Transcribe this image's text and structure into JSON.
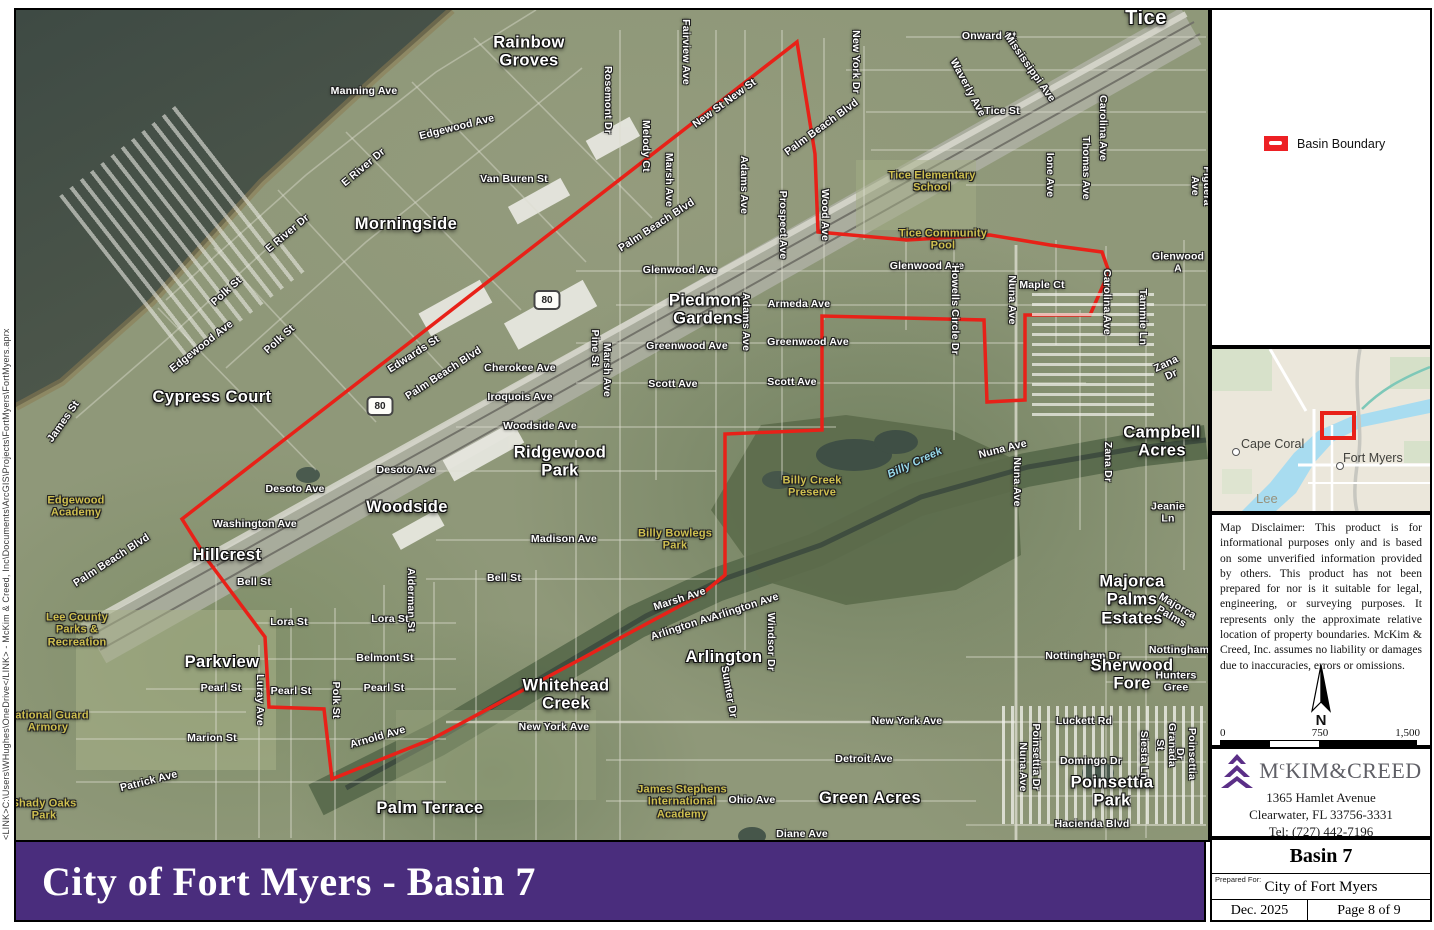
{
  "file_path_text": "<LINK>C:\\Users\\WHughes\\OneDrive</LINK> - McKim & Creed, Inc\\Documents\\ArcGIS\\Projects\\FortMyers\\FortMyers.aprx",
  "banner": {
    "title": "City of Fort Myers - Basin 7"
  },
  "theme": {
    "purple": "#4a2d7d",
    "logo_purple": "#5b2f87",
    "boundary_red": "#e82118"
  },
  "legend": {
    "items": [
      {
        "label": "Basin Boundary",
        "color": "#ed2024"
      }
    ]
  },
  "inset": {
    "cape_coral": "Cape Coral",
    "fort_myers": "Fort Myers",
    "county": "Lee"
  },
  "disclaimer": "Map Disclaimer: This product is for informational purposes only and is based on some unverified information provided by others. This product has not been prepared for nor is it suitable for legal, engineering, or surveying purposes. It represents only the approximate relative location of property boundaries. McKim & Creed, Inc. assumes no liability or damages due to inaccuracies, errors or omissions.",
  "north_label": "N",
  "scale_bar": {
    "start": "0",
    "mid": "750",
    "end": "1,500",
    "units": "Feet"
  },
  "company": {
    "name_prefix": "M",
    "name_sup": "c",
    "name_rest": "KIM&CREED",
    "address1": "1365 Hamlet Avenue",
    "address2": "Clearwater, FL 33756-3331",
    "phone": "Tel: (727) 442-7196"
  },
  "title_block": {
    "title": "Basin 7",
    "prepared_for_label": "Prepared For:",
    "prepared_for": "City of Fort Myers",
    "date": "Dec. 2025",
    "page": "Page 8 of 9"
  },
  "map": {
    "highway_shield": "80",
    "boundary_color": "#e82118",
    "shields": [
      {
        "x": 531,
        "y": 290
      },
      {
        "x": 364,
        "y": 396
      }
    ],
    "boundary_points": [
      [
        781,
        32
      ],
      [
        799,
        144
      ],
      [
        802,
        222
      ],
      [
        891,
        230
      ],
      [
        974,
        225
      ],
      [
        1034,
        235
      ],
      [
        1086,
        242
      ],
      [
        1093,
        262
      ],
      [
        1074,
        305
      ],
      [
        1009,
        305
      ],
      [
        1009,
        390
      ],
      [
        971,
        392
      ],
      [
        968,
        310
      ],
      [
        806,
        306
      ],
      [
        806,
        420
      ],
      [
        709,
        424
      ],
      [
        709,
        565
      ],
      [
        686,
        584
      ],
      [
        416,
        729
      ],
      [
        316,
        769
      ],
      [
        308,
        699
      ],
      [
        253,
        697
      ],
      [
        249,
        627
      ],
      [
        193,
        552
      ],
      [
        166,
        509
      ]
    ],
    "labels": [
      {
        "t": "Onward St",
        "x": 973,
        "y": 27
      },
      {
        "t": "Rainbow\nGroves",
        "x": 513,
        "y": 42,
        "c": "pl"
      },
      {
        "t": "Manning Ave",
        "x": 348,
        "y": 82
      },
      {
        "t": "Edgewood Ave",
        "x": 441,
        "y": 118,
        "r": -14
      },
      {
        "t": "New St New St",
        "x": 709,
        "y": 94,
        "r": -36
      },
      {
        "t": "Palm Beach Blvd",
        "x": 806,
        "y": 118,
        "r": -36
      },
      {
        "t": "Van Buren St",
        "x": 498,
        "y": 170
      },
      {
        "t": "Morningside",
        "x": 390,
        "y": 214,
        "c": "pl"
      },
      {
        "t": "E River Dr",
        "x": 348,
        "y": 158,
        "r": -40
      },
      {
        "t": "E River Dr",
        "x": 272,
        "y": 224,
        "r": -40
      },
      {
        "t": "Rosemont Dr",
        "x": 591,
        "y": 90,
        "r": 90
      },
      {
        "t": "Melody Ct",
        "x": 629,
        "y": 136,
        "r": 90
      },
      {
        "t": "Marsh Ave",
        "x": 652,
        "y": 170,
        "r": 90
      },
      {
        "t": "Fairview Ave",
        "x": 669,
        "y": 42,
        "r": 90
      },
      {
        "t": "New York Dr",
        "x": 839,
        "y": 52,
        "r": 90
      },
      {
        "t": "Waverly Ave",
        "x": 951,
        "y": 78,
        "r": 62
      },
      {
        "t": "Mississippi Ave",
        "x": 1013,
        "y": 58,
        "r": 55
      },
      {
        "t": "Tice",
        "x": 1130,
        "y": 8,
        "c": "pl2"
      },
      {
        "t": "Tice St",
        "x": 986,
        "y": 102
      },
      {
        "t": "Carolina Ave",
        "x": 1086,
        "y": 118,
        "r": 90
      },
      {
        "t": "Carolina Ave",
        "x": 1090,
        "y": 292,
        "r": 90
      },
      {
        "t": "Thomas Ave",
        "x": 1069,
        "y": 158,
        "r": 90
      },
      {
        "t": "Ione Ave",
        "x": 1033,
        "y": 165,
        "r": 90
      },
      {
        "t": "Figuera Ave",
        "x": 1184,
        "y": 176,
        "r": 90
      },
      {
        "t": "Tice Elementary\nSchool",
        "x": 916,
        "y": 172,
        "c": "fac"
      },
      {
        "t": "Tice Community\nPool",
        "x": 927,
        "y": 230,
        "c": "fac"
      },
      {
        "t": "Glenwood Ave",
        "x": 664,
        "y": 261
      },
      {
        "t": "Glenwood Ave",
        "x": 911,
        "y": 257
      },
      {
        "t": "Glenwood A",
        "x": 1162,
        "y": 253
      },
      {
        "t": "Maple Ct",
        "x": 1026,
        "y": 276
      },
      {
        "t": "Piedmont\nGardens",
        "x": 692,
        "y": 300,
        "c": "pl"
      },
      {
        "t": "Armeda Ave",
        "x": 783,
        "y": 295
      },
      {
        "t": "Adams Ave",
        "x": 727,
        "y": 175,
        "r": 90
      },
      {
        "t": "Adams Ave",
        "x": 729,
        "y": 312,
        "r": 90
      },
      {
        "t": "Prospect Ave",
        "x": 766,
        "y": 215,
        "r": 90
      },
      {
        "t": "Wood Ave",
        "x": 808,
        "y": 205,
        "r": 90
      },
      {
        "t": "Howells Circle Dr",
        "x": 938,
        "y": 300,
        "r": 90
      },
      {
        "t": "Nuna Ave",
        "x": 995,
        "y": 290,
        "r": 90
      },
      {
        "t": "Greenwood Ave",
        "x": 671,
        "y": 337
      },
      {
        "t": "Greenwood Ave",
        "x": 792,
        "y": 333
      },
      {
        "t": "Scott Ave",
        "x": 657,
        "y": 375
      },
      {
        "t": "Scott Ave",
        "x": 776,
        "y": 373
      },
      {
        "t": "Marsh Ave",
        "x": 590,
        "y": 360,
        "r": 90
      },
      {
        "t": "Pine St",
        "x": 578,
        "y": 338,
        "r": 90
      },
      {
        "t": "Cherokee Ave",
        "x": 504,
        "y": 359
      },
      {
        "t": "Iroquois Ave",
        "x": 504,
        "y": 388
      },
      {
        "t": "Woodside Ave",
        "x": 524,
        "y": 417
      },
      {
        "t": "Ridgewood\nPark",
        "x": 544,
        "y": 452,
        "c": "pl"
      },
      {
        "t": "Madison Ave",
        "x": 548,
        "y": 530
      },
      {
        "t": "Bell St",
        "x": 488,
        "y": 569
      },
      {
        "t": "Bell St",
        "x": 238,
        "y": 573
      },
      {
        "t": "Desoto Ave",
        "x": 279,
        "y": 480
      },
      {
        "t": "Desoto Ave",
        "x": 390,
        "y": 461
      },
      {
        "t": "Woodside",
        "x": 391,
        "y": 497,
        "c": "pl"
      },
      {
        "t": "Washington Ave",
        "x": 239,
        "y": 515
      },
      {
        "t": "Hillcrest",
        "x": 211,
        "y": 545,
        "c": "pl"
      },
      {
        "t": "Alderman St",
        "x": 394,
        "y": 590,
        "r": 90
      },
      {
        "t": "Polk St",
        "x": 211,
        "y": 282,
        "r": -42
      },
      {
        "t": "Polk St",
        "x": 264,
        "y": 330,
        "r": -42
      },
      {
        "t": "Polk St",
        "x": 319,
        "y": 690,
        "r": 90
      },
      {
        "t": "James St",
        "x": 48,
        "y": 412,
        "r": -55
      },
      {
        "t": "Edgewood Ave",
        "x": 186,
        "y": 337,
        "r": -38
      },
      {
        "t": "Cypress Court",
        "x": 196,
        "y": 387,
        "c": "pl"
      },
      {
        "t": "Edgewood\nAcademy",
        "x": 60,
        "y": 497,
        "c": "fac"
      },
      {
        "t": "Edwards St",
        "x": 398,
        "y": 345,
        "r": -33
      },
      {
        "t": "Palm Beach Blvd",
        "x": 428,
        "y": 364,
        "r": -33
      },
      {
        "t": "Palm Beach Blvd",
        "x": 641,
        "y": 216,
        "r": -33
      },
      {
        "t": "Palm Beach Blvd",
        "x": 96,
        "y": 551,
        "r": -33
      },
      {
        "t": "Lee County\nParks &\nRecreation",
        "x": 61,
        "y": 620,
        "c": "fac"
      },
      {
        "t": "Parkview",
        "x": 206,
        "y": 652,
        "c": "pl"
      },
      {
        "t": "Lora St",
        "x": 273,
        "y": 613
      },
      {
        "t": "Lora St",
        "x": 374,
        "y": 610
      },
      {
        "t": "Belmont St",
        "x": 369,
        "y": 649
      },
      {
        "t": "Pearl St",
        "x": 205,
        "y": 679
      },
      {
        "t": "Pearl St",
        "x": 275,
        "y": 682
      },
      {
        "t": "Pearl St",
        "x": 368,
        "y": 679
      },
      {
        "t": "Luray Ave",
        "x": 243,
        "y": 690,
        "r": 90
      },
      {
        "t": "Marion St",
        "x": 196,
        "y": 729
      },
      {
        "t": "Arnold Ave",
        "x": 362,
        "y": 728,
        "r": -16
      },
      {
        "t": "Patrick Ave",
        "x": 133,
        "y": 772,
        "r": -14
      },
      {
        "t": "National Guard\nArmory",
        "x": 32,
        "y": 712,
        "c": "fac"
      },
      {
        "t": "Shady Oaks\nPark",
        "x": 28,
        "y": 800,
        "c": "fac"
      },
      {
        "t": "Palm Terrace",
        "x": 414,
        "y": 798,
        "c": "pl"
      },
      {
        "t": "Whitehead\nCreek",
        "x": 550,
        "y": 685,
        "c": "pl"
      },
      {
        "t": "New York Ave",
        "x": 538,
        "y": 718
      },
      {
        "t": "New York Ave",
        "x": 891,
        "y": 712
      },
      {
        "t": "Marsh Ave",
        "x": 664,
        "y": 590,
        "r": -18
      },
      {
        "t": "Arlington Ave",
        "x": 669,
        "y": 617,
        "r": -18
      },
      {
        "t": "Arlington Ave",
        "x": 729,
        "y": 598,
        "r": -18
      },
      {
        "t": "Arlington",
        "x": 708,
        "y": 647,
        "c": "pl"
      },
      {
        "t": "Windsor Dr",
        "x": 754,
        "y": 632,
        "r": 90
      },
      {
        "t": "Sumter Dr",
        "x": 712,
        "y": 682,
        "r": 80
      },
      {
        "t": "Detroit Ave",
        "x": 848,
        "y": 750
      },
      {
        "t": "Ohio Ave",
        "x": 736,
        "y": 791
      },
      {
        "t": "James Stephens\nInternational\nAcademy",
        "x": 666,
        "y": 792,
        "c": "fac"
      },
      {
        "t": "Green Acres",
        "x": 854,
        "y": 788,
        "c": "pl"
      },
      {
        "t": "Diane Ave",
        "x": 786,
        "y": 825
      },
      {
        "t": "Luckett Rd",
        "x": 1068,
        "y": 712
      },
      {
        "t": "Domingo Dr",
        "x": 1075,
        "y": 752
      },
      {
        "t": "Poinsettia Park",
        "x": 1096,
        "y": 782,
        "c": "pl"
      },
      {
        "t": "Hacienda Blvd",
        "x": 1076,
        "y": 815
      },
      {
        "t": "Poinsettia Dr",
        "x": 1019,
        "y": 747,
        "r": 90
      },
      {
        "t": "Poinsettia Dr",
        "x": 1169,
        "y": 744,
        "r": 90
      },
      {
        "t": "Granada St",
        "x": 1149,
        "y": 735,
        "r": 90
      },
      {
        "t": "Siesta Ln",
        "x": 1127,
        "y": 745,
        "r": 90
      },
      {
        "t": "Nottingham Dr",
        "x": 1067,
        "y": 647
      },
      {
        "t": "Nottingham",
        "x": 1163,
        "y": 641
      },
      {
        "t": "Sherwood\nFore",
        "x": 1116,
        "y": 665,
        "c": "pl"
      },
      {
        "t": "Hunters Gree",
        "x": 1160,
        "y": 672
      },
      {
        "t": "Majorca Palms\nEstates",
        "x": 1116,
        "y": 590,
        "c": "pl"
      },
      {
        "t": "Majorca Palms",
        "x": 1158,
        "y": 602,
        "r": 30
      },
      {
        "t": "Nuna Ave",
        "x": 987,
        "y": 440,
        "r": -14
      },
      {
        "t": "Nuna Ave",
        "x": 1000,
        "y": 472,
        "r": 90
      },
      {
        "t": "Nuna Ave",
        "x": 1006,
        "y": 757,
        "r": 90
      },
      {
        "t": "Zana Dr",
        "x": 1153,
        "y": 360,
        "r": -25
      },
      {
        "t": "Zana Dr",
        "x": 1091,
        "y": 452,
        "r": 90
      },
      {
        "t": "Campbell\nAcres",
        "x": 1146,
        "y": 432,
        "c": "pl"
      },
      {
        "t": "Jeanie Ln",
        "x": 1152,
        "y": 503
      },
      {
        "t": "Tammie Ln",
        "x": 1126,
        "y": 307,
        "r": 90
      },
      {
        "t": "Billy Bowlegs\nPark",
        "x": 659,
        "y": 530,
        "c": "fac"
      },
      {
        "t": "Billy Creek\nPreserve",
        "x": 796,
        "y": 477,
        "c": "fac"
      },
      {
        "t": "Billy Creek",
        "x": 899,
        "y": 453,
        "r": -25,
        "c": "wtr"
      }
    ]
  }
}
